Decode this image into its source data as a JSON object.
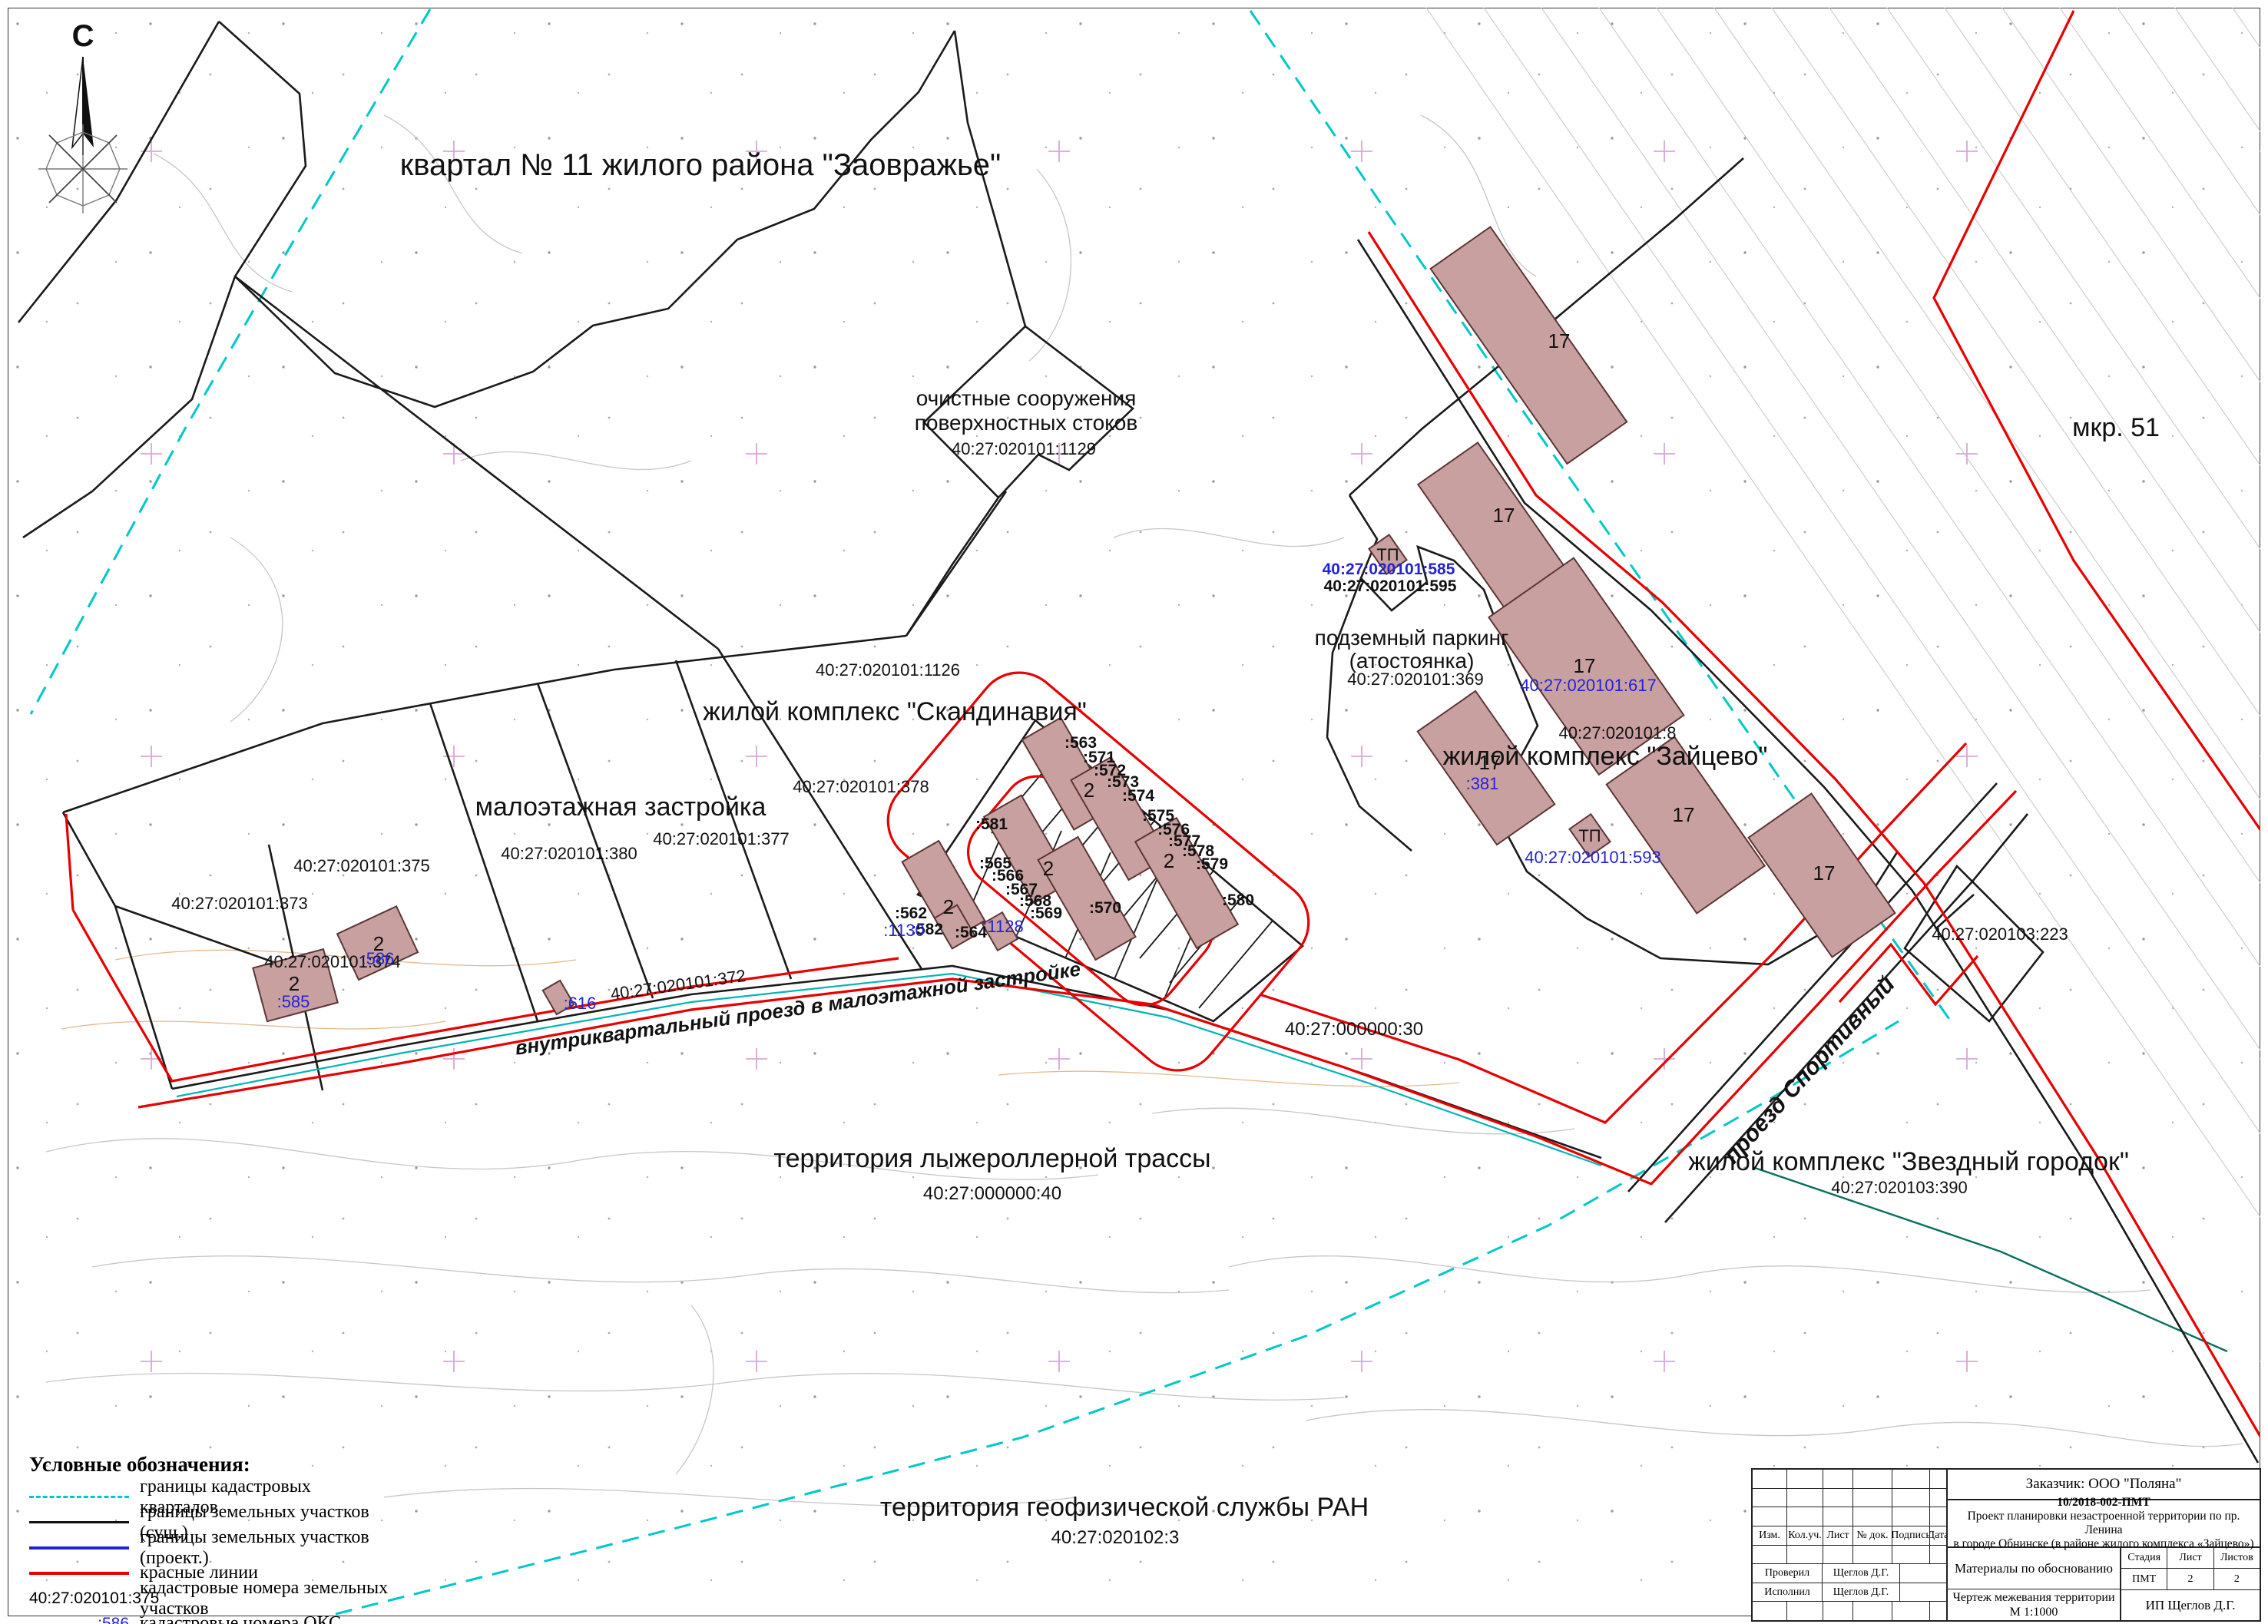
{
  "map": {
    "labels": {
      "north": "С",
      "kvartal11": "квартал № 11 жилого района \"Заовражье\"",
      "ochistnye1": "очистные сооружения",
      "ochistnye2": "поверхностных стоков",
      "n1129": "40:27:020101:1129",
      "skandinavia": "жилой комплекс \"Скандинавия\"",
      "n1126": "40:27:020101:1126",
      "maloetazhnaya": "малоэтажная застройка",
      "n378": "40:27:020101:378",
      "n377": "40:27:020101:377",
      "n380": "40:27:020101:380",
      "n375": "40:27:020101:375",
      "n373": "40:27:020101:373",
      "n374": "40:27:020101:374",
      "n372": "40:27:020101:372",
      "road": "внутриквартальный проезд в малоэтажной застройке",
      "ski": "территория лыжероллерной трассы",
      "n40": "40:27:000000:40",
      "n30": "40:27:000000:30",
      "geo": "территория геофизической службы РАН",
      "ngeo": "40:27:020102:3",
      "parking1": "подземный паркинг",
      "parking2": "(атостоянка)",
      "n369": "40:27:020101:369",
      "n585": "40:27:020101:585",
      "n595": "40:27:020101:595",
      "n617": "40:27:020101:617",
      "n593": "40:27:020101:593",
      "zaitsevo": "жилой комплекс \"Зайцево\"",
      "n8": "40:27:020101:8",
      "mkr51": "мкр. 51",
      "n223": "40:27:020103:223",
      "sport": "проезд Спортивный",
      "zvezdny": "жилой комплекс \"Звездный городок\"",
      "n390": "40:27:020103:390"
    },
    "oks": {
      "b381": ":381",
      "b585": ":585",
      "b586": ":586",
      "b616": ":616",
      "b1128": ":1128",
      "b1130": ":1130"
    },
    "plots": {
      "p562": ":562",
      "p563": ":563",
      "p564": ":564",
      "p565": ":565",
      "p566": ":566",
      "p567": ":567",
      "p568": ":568",
      "p569": ":569",
      "p570": ":570",
      "p571": ":571",
      "p572": ":572",
      "p573": ":573",
      "p574": ":574",
      "p575": ":575",
      "p576": ":576",
      "p577": ":577",
      "p578": ":578",
      "p579": ":579",
      "p580": ":580",
      "p581": ":581",
      "p582": ":582"
    },
    "bld": {
      "cottage": "2",
      "tower": "17",
      "tp": "ТП"
    },
    "colors": {
      "quarter_border": "#00c8c8",
      "existing_border": "#1a1a1a",
      "project_border": "#2323d6",
      "red_line": "#e80000",
      "oks_number": "#2323d6",
      "building_fill": "#c8a0a0"
    }
  },
  "legend": {
    "title": "Условные обозначения:",
    "items": [
      {
        "swatch": "cyan-dashed",
        "label": "границы кадастровых кварталов"
      },
      {
        "swatch": "black-line",
        "label": "границы земельных участков (сущ.)"
      },
      {
        "swatch": "blue-line",
        "label": "границы земельных участков (проект.)"
      },
      {
        "swatch": "red-line",
        "label": "красные линии"
      },
      {
        "code": "40:27:020101:375",
        "label": "кадастровые номера земельных участков"
      },
      {
        "code": ":586",
        "label": "кадастровые номера ОКС"
      }
    ]
  },
  "stamp": {
    "customer": "Заказчик: ООО \"Поляна\"",
    "project_code": "10/2018-002-ПМТ",
    "project_name1": "Проект планировки незастроенной территории по пр. Ленина",
    "project_name2": "в городе Обнинске (в районе жилого комплекса «Зайцево»)",
    "section": "Материалы по обоснованию",
    "stage_label": "Стадия",
    "sheet_label": "Лист",
    "sheets_label": "Листов",
    "stage": "ПМТ",
    "sheet": "2",
    "sheets": "2",
    "drawing_title1": "Чертеж межевания территории",
    "drawing_title2": "М 1:1000",
    "author_org": "ИП Щеглов Д.Г.",
    "col_izm": "Изм.",
    "col_koluch": "Кол.уч.",
    "col_list": "Лист",
    "col_ndok": "№ док.",
    "col_podpis": "Подпись",
    "col_data": "Дата",
    "checked_label": "Проверил",
    "checked_name": "Щеглов Д.Г.",
    "executed_label": "Исполнил",
    "executed_name": "Щеглов Д.Г."
  }
}
